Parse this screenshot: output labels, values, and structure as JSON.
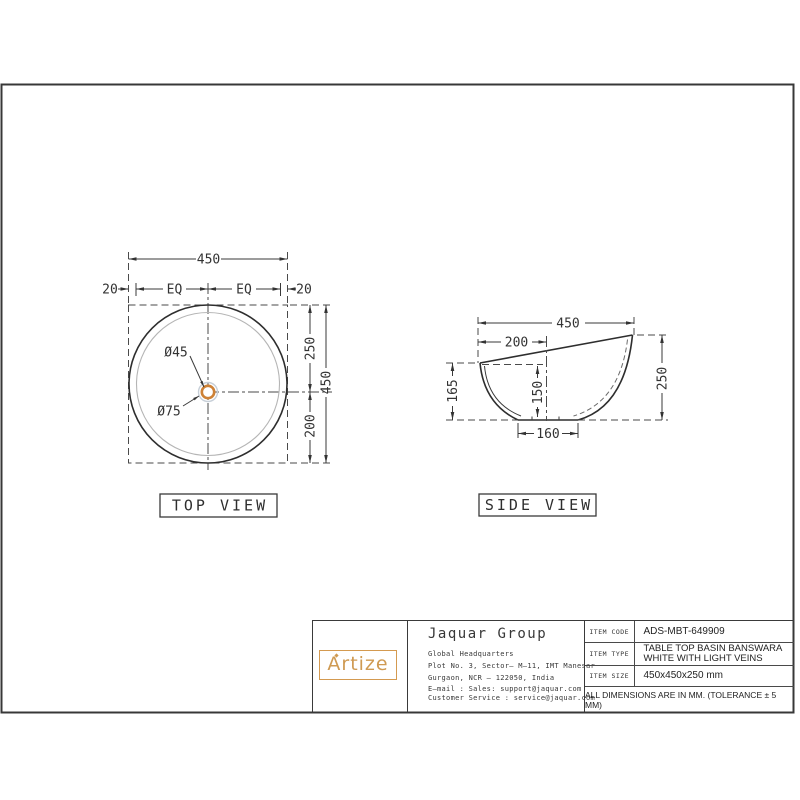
{
  "top_view": {
    "label": "TOP VIEW",
    "dim_width": "450",
    "dim_left": "20",
    "dim_eq1": "EQ",
    "dim_eq2": "EQ",
    "dim_right": "20",
    "dim_top_to_center": "250",
    "dim_center_to_bottom": "200",
    "dim_height": "450",
    "dim_drain": "Ø45",
    "dim_recess": "Ø75"
  },
  "side_view": {
    "label": "SIDE VIEW",
    "dim_width": "450",
    "dim_rim_offset": "200",
    "dim_height": "250",
    "dim_left_height": "165",
    "dim_depth": "150",
    "dim_base": "160"
  },
  "title_block": {
    "brand": "Artize",
    "company": "Jaquar Group",
    "line1": "Global Headquarters",
    "line2": "Plot No. 3, Sector– M–11, IMT Manesar",
    "line3": "Gurgaon, NCR – 122050, India",
    "line4": "E–mail : Sales: support@jaquar.com",
    "line5": "Customer Service : service@jaquar.com",
    "item_code_label": "ITEM CODE",
    "item_code": "ADS-MBT-649909",
    "item_type_label": "ITEM TYPE",
    "item_type_line1": "TABLE TOP BASIN BANSWARA",
    "item_type_line2": "WHITE WITH LIGHT VEINS",
    "item_size_label": "ITEM SIZE",
    "item_size": "450x450x250 mm",
    "note": "ALL DIMENSIONS ARE IN MM. (TOLERANCE ± 5 MM)"
  },
  "colors": {
    "accent_orange": "#cd8136",
    "logo_orange": "#cf9a52",
    "line": "#3a3a3a"
  }
}
